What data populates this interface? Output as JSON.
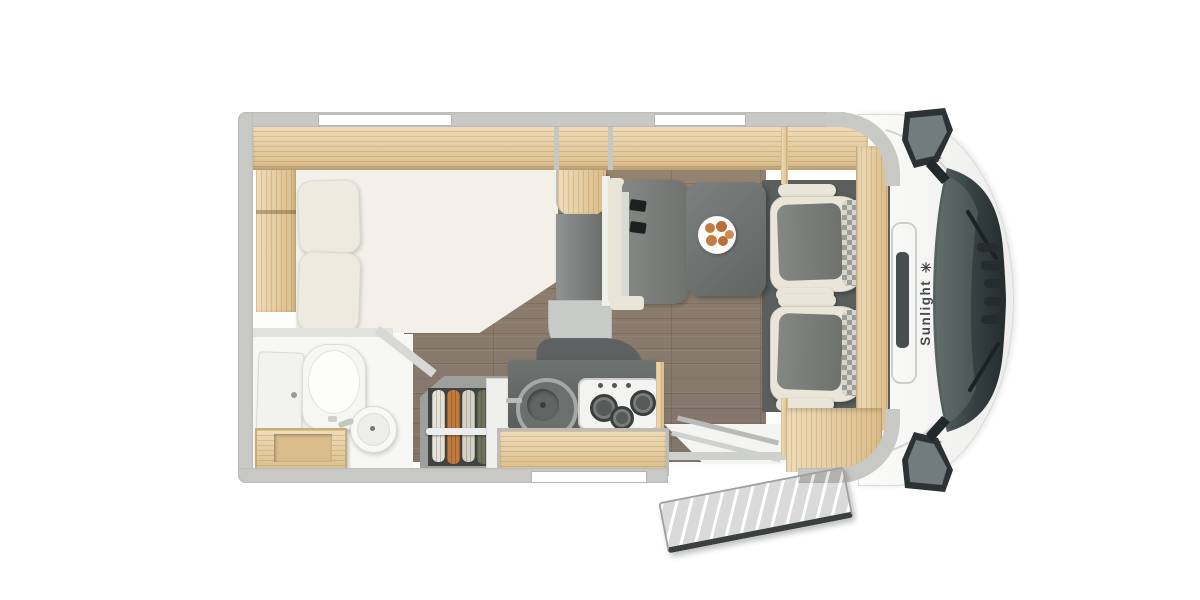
{
  "image": {
    "type": "motorhome floor plan, top-down 3D render",
    "background": "#ffffff"
  },
  "brand": {
    "name": "Sunlight",
    "logo_glyph": "✳",
    "text_color": "#454a4d"
  },
  "colors": {
    "wall": "#c8c8c5",
    "wood": "#e8cd9b",
    "floor_wood": "#8b7d71",
    "counter_dark": "#636766",
    "table_gray": "#6e7271",
    "seat_cream": "#e9e5d8",
    "seat_gray": "#7b7e7b",
    "cab_body": "#f6f7f6",
    "windshield_glass": "#3a4445",
    "clothes_orange": "#c07a3a",
    "clothes_green": "#6d7258",
    "food_rolls": "#c57c42"
  },
  "features": {
    "rear_bed": "french-bed-with-two-pillows",
    "overhead_lockers": "wood-overhead-lockers",
    "bathroom": "washroom-toilet-basin-vanity",
    "wardrobe": "wardrobe-with-hanging-clothes",
    "kitchen": "kitchenette-sink-and-3-burner-hob",
    "dinette": "dinette-table-with-belted-bench",
    "plate": "plate-with-bread-rolls",
    "cab_seats": "two-swivel-captain-seats",
    "entry_door": "open-entry-door",
    "cab": "driver-cab-windshield-wipers-mirrors",
    "window_count": 3
  }
}
